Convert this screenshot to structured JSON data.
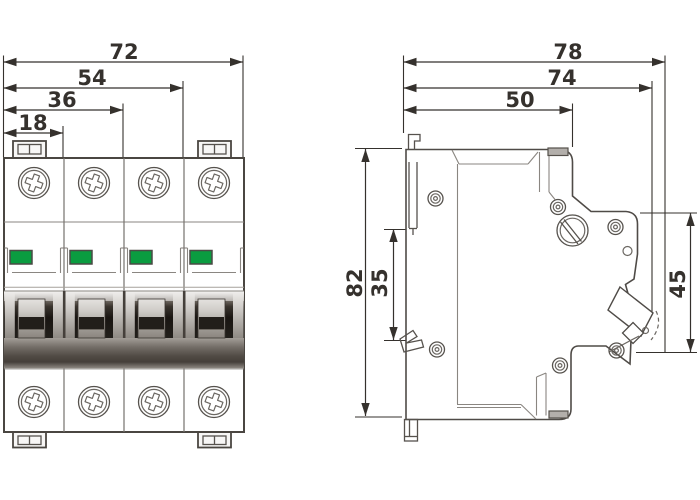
{
  "front_view": {
    "dims": {
      "w_total": "72",
      "w_3pole": "54",
      "w_2pole": "36",
      "w_1pole": "18"
    }
  },
  "side_view": {
    "dims": {
      "depth_total": "78",
      "depth_with_lever": "74",
      "depth_body": "50",
      "height_total": "82",
      "height_din": "35",
      "height_front": "45"
    }
  },
  "colors": {
    "indicator_green": "#0a9c40",
    "line": "#35312d"
  }
}
